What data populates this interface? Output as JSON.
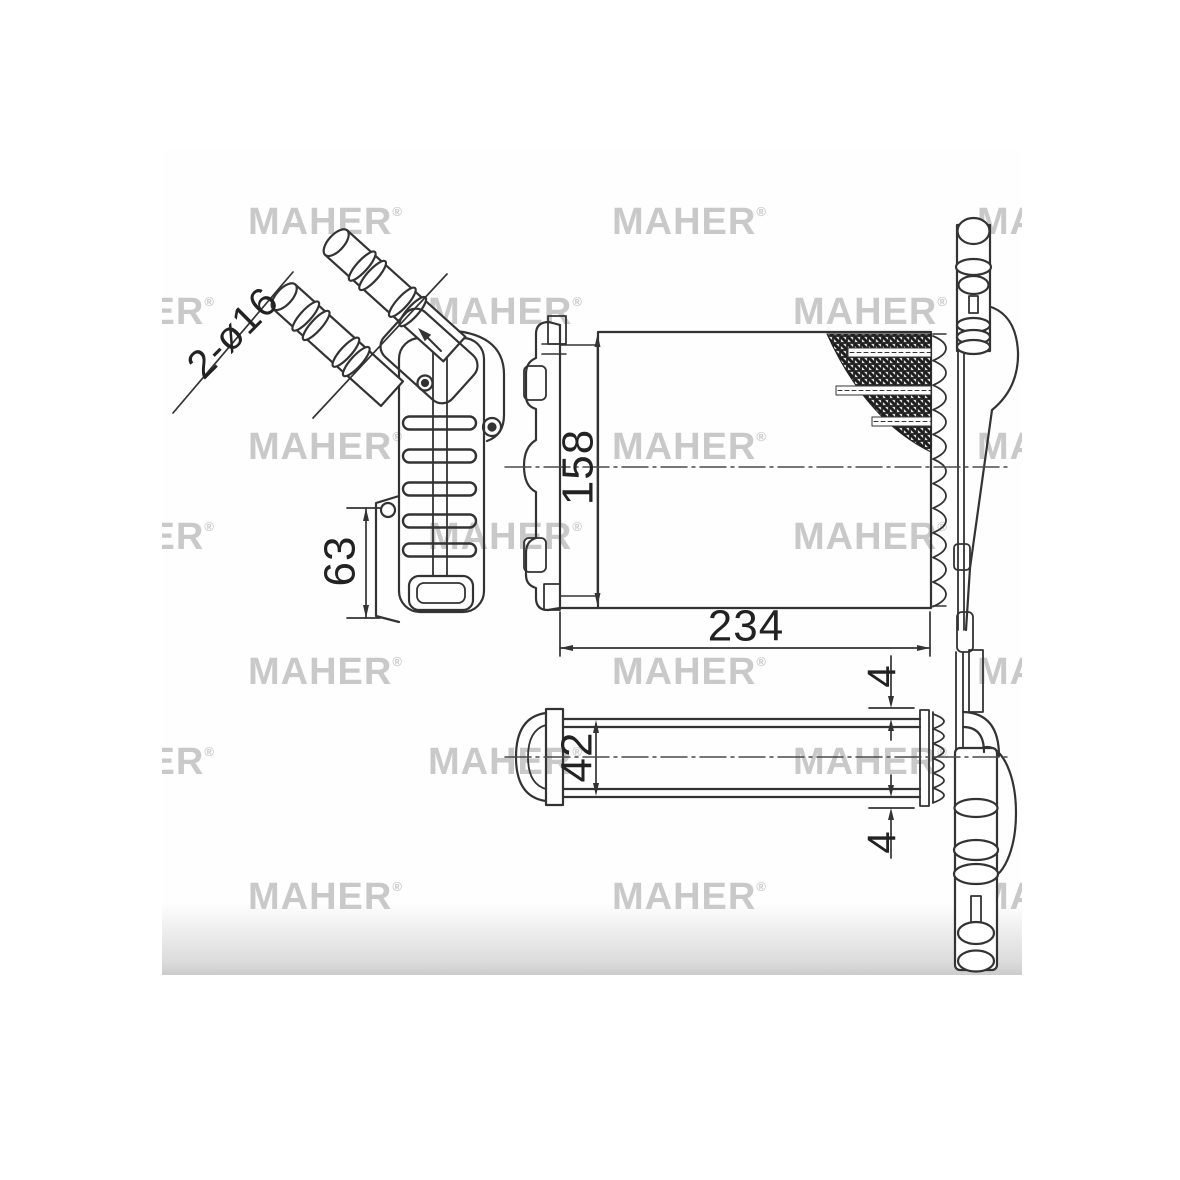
{
  "watermark": {
    "text": "MAHER",
    "registered_mark": "®",
    "color": "#b5b5b5",
    "rows": [
      {
        "y": 53,
        "x": [
          86,
          450,
          815
        ]
      },
      {
        "y": 143,
        "x": [
          -102,
          266,
          631
        ]
      },
      {
        "y": 278,
        "x": [
          86,
          450,
          815
        ]
      },
      {
        "y": 368,
        "x": [
          -102,
          266,
          631
        ]
      },
      {
        "y": 503,
        "x": [
          86,
          450,
          815
        ]
      },
      {
        "y": 593,
        "x": [
          -102,
          266,
          631
        ]
      },
      {
        "y": 728,
        "x": [
          86,
          450,
          815
        ]
      },
      {
        "y": 818,
        "x": [
          -102,
          266,
          631
        ]
      }
    ]
  },
  "drawing": {
    "line_color": "#333333",
    "dimensions": {
      "pipe_callout": "2-ø16",
      "core_height_mm": "158",
      "core_width_mm": "234",
      "mount_height_mm": "63",
      "core_depth_mm": "42",
      "plate_offset_top_mm": "4",
      "plate_offset_bottom_mm": "4"
    }
  }
}
